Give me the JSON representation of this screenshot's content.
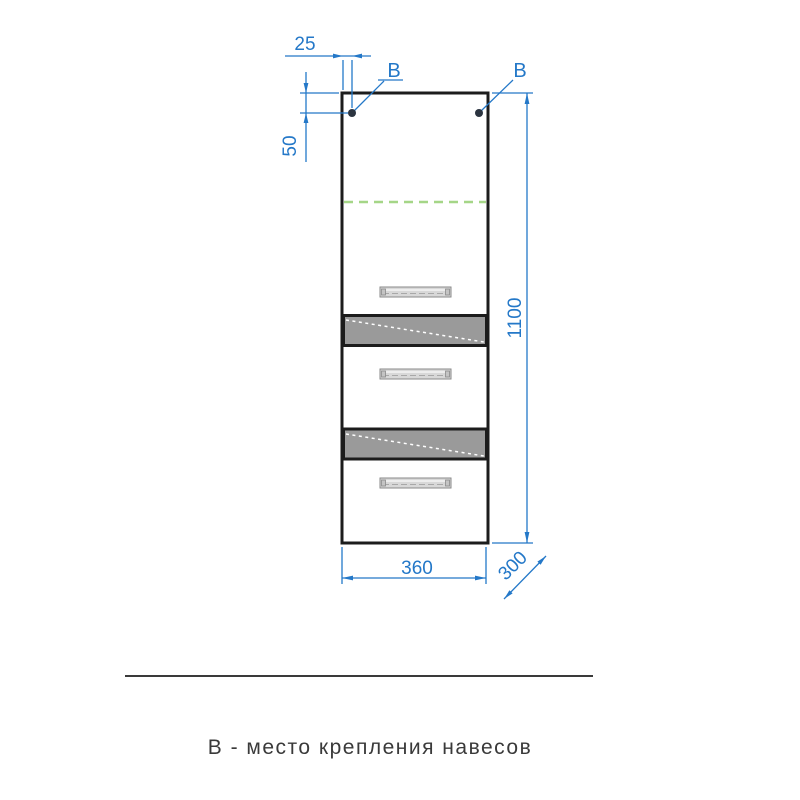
{
  "colors": {
    "dimension": "#2478c8",
    "outline": "#1c1c1c",
    "panel": "#9a9a9a",
    "shelf": "#a5d687",
    "dot": "#2b3440",
    "caption": "#3a3a3a"
  },
  "drawing": {
    "dim_offset_x": "25",
    "dim_offset_y": "50",
    "dim_height": "1100",
    "dim_width": "360",
    "dim_depth": "300",
    "mount_label_left": "В",
    "mount_label_right": "В"
  },
  "caption": {
    "text": "В - место крепления навесов"
  }
}
